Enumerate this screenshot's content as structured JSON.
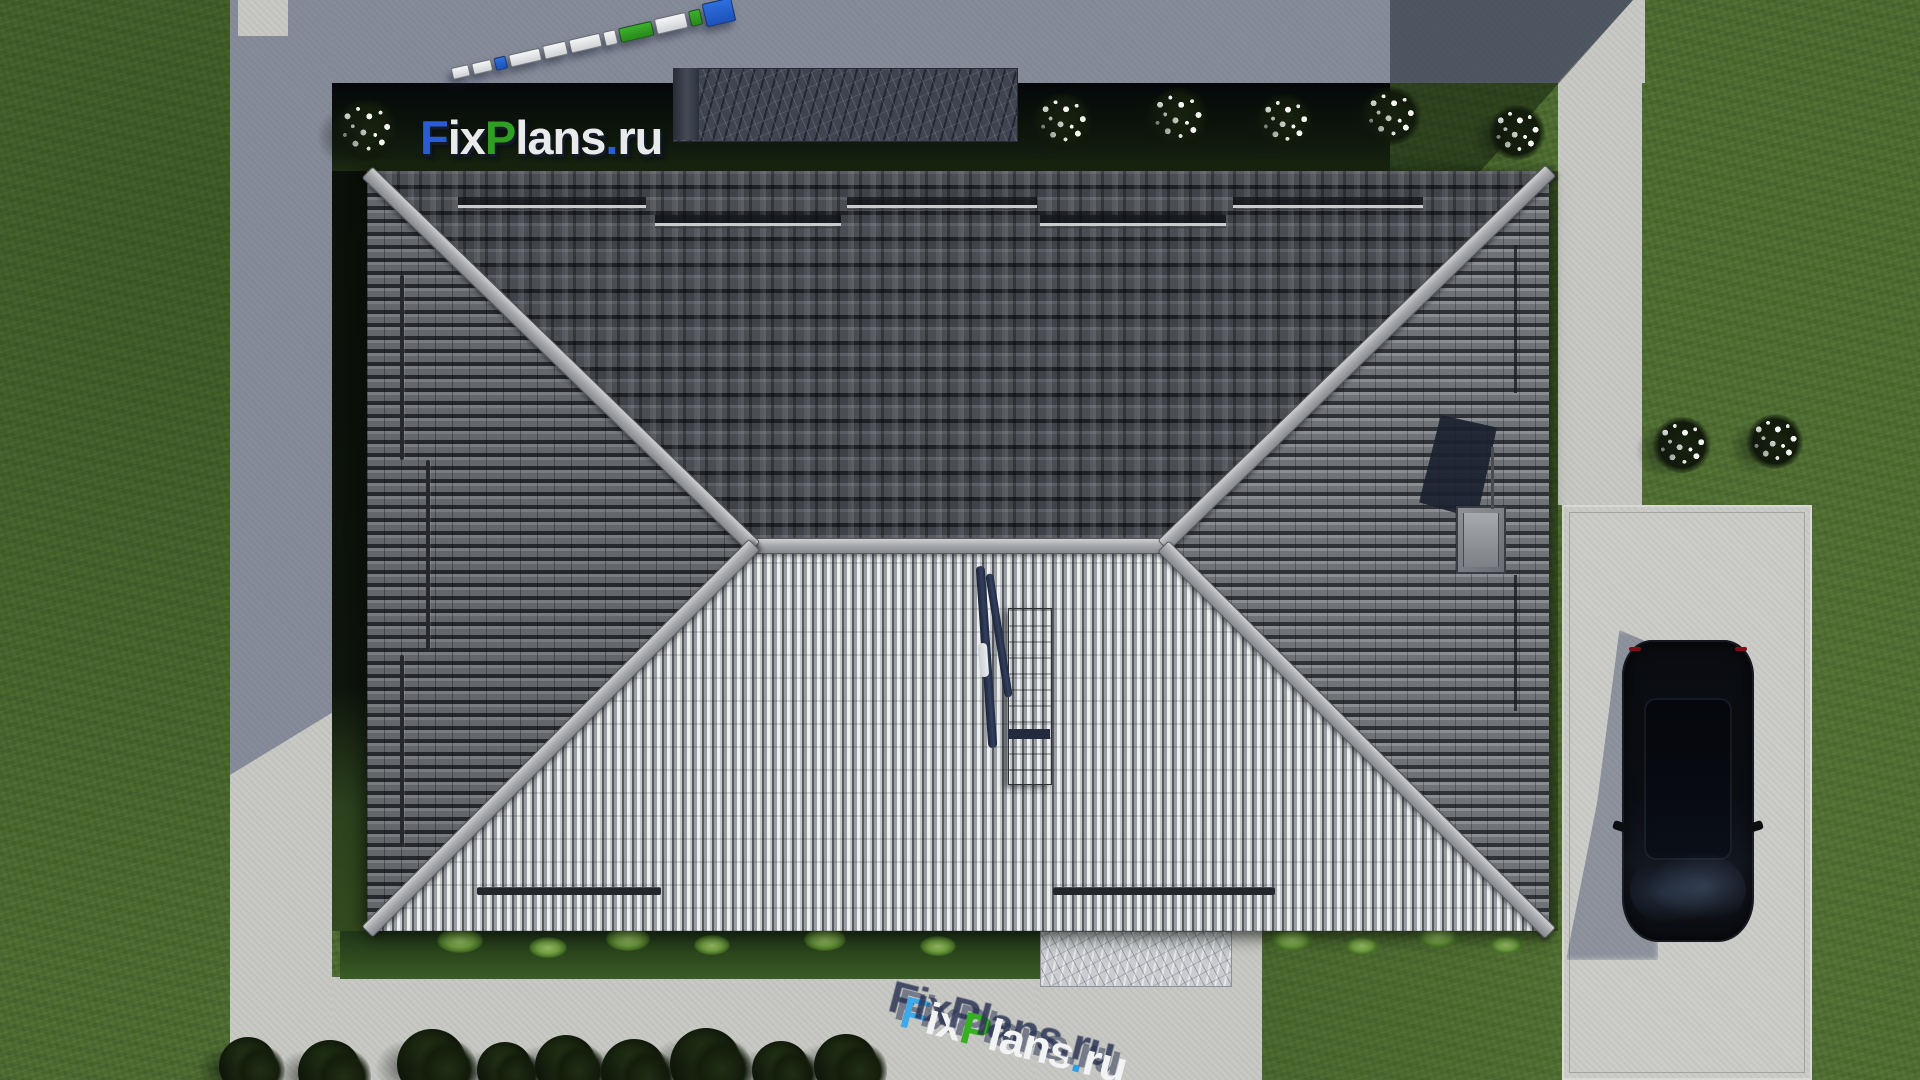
{
  "watermark": {
    "site_top": "FixPlans.ru",
    "site_bottom": "FixPlans.ru",
    "letters_top": [
      {
        "t": "F",
        "c": "#2b5bd7"
      },
      {
        "t": "ix",
        "c": "#e9eaec"
      },
      {
        "t": "P",
        "c": "#2f9e23"
      },
      {
        "t": "lans",
        "c": "#e9eaec"
      },
      {
        "t": ".",
        "c": "#2b5bd7"
      },
      {
        "t": "ru",
        "c": "#e9eaec"
      }
    ],
    "letters_bottom": [
      {
        "t": "F",
        "c": "#3fa8e8"
      },
      {
        "t": "ix",
        "c": "#f2f3f4"
      },
      {
        "t": "P",
        "c": "#35b01e"
      },
      {
        "t": "lans",
        "c": "#f2f3f4"
      },
      {
        "t": ".",
        "c": "#2e9fe6"
      },
      {
        "t": "ru",
        "c": "#f2f3f4"
      }
    ]
  },
  "colors": {
    "brand_blue": "#1d5fd2",
    "brand_green": "#2f9e23",
    "grass": "#4d6c30",
    "pavement": "#c7c8c4",
    "roof_dark_tile": "#3b3d42",
    "roof_light_seam": "#c3c6c9",
    "ridge_cap": "#a7a9ad",
    "shadow_tint": "rgba(44,56,94,0.42)",
    "car_body": "#0b0e13"
  },
  "scene": {
    "ruler_segments": [
      {
        "w": 16,
        "h": 10,
        "c": "w"
      },
      {
        "w": 18,
        "h": 10,
        "c": "w"
      },
      {
        "w": 10,
        "h": 11,
        "c": "b"
      },
      {
        "w": 30,
        "h": 11,
        "c": "w"
      },
      {
        "w": 22,
        "h": 12,
        "c": "w"
      },
      {
        "w": 30,
        "h": 12,
        "c": "w"
      },
      {
        "w": 11,
        "h": 13,
        "c": "w"
      },
      {
        "w": 32,
        "h": 13,
        "c": "g"
      },
      {
        "w": 30,
        "h": 14,
        "c": "w"
      },
      {
        "w": 10,
        "h": 14,
        "c": "g"
      },
      {
        "w": 28,
        "h": 22,
        "c": "b"
      }
    ],
    "flower_bushes": [
      {
        "x": 366,
        "y": 132,
        "s": 66
      },
      {
        "x": 1063,
        "y": 124,
        "s": 62
      },
      {
        "x": 1178,
        "y": 120,
        "s": 64
      },
      {
        "x": 1285,
        "y": 124,
        "s": 60
      },
      {
        "x": 1391,
        "y": 118,
        "s": 62
      },
      {
        "x": 1517,
        "y": 134,
        "s": 58
      },
      {
        "x": 1682,
        "y": 447,
        "s": 60
      },
      {
        "x": 1775,
        "y": 443,
        "s": 58
      }
    ],
    "bed_shrubs": [
      {
        "x": 460,
        "y": 942,
        "s": 46
      },
      {
        "x": 548,
        "y": 948,
        "s": 38
      },
      {
        "x": 628,
        "y": 940,
        "s": 44
      },
      {
        "x": 712,
        "y": 946,
        "s": 36
      },
      {
        "x": 825,
        "y": 941,
        "s": 42
      },
      {
        "x": 938,
        "y": 947,
        "s": 36
      },
      {
        "x": 1292,
        "y": 941,
        "s": 42
      },
      {
        "x": 1362,
        "y": 946,
        "s": 34
      },
      {
        "x": 1438,
        "y": 938,
        "s": 42
      },
      {
        "x": 1506,
        "y": 945,
        "s": 34
      }
    ],
    "bottom_trees": [
      {
        "x": 248,
        "y": 1066,
        "s": 58
      },
      {
        "x": 330,
        "y": 1072,
        "s": 64
      },
      {
        "x": 432,
        "y": 1064,
        "s": 70
      },
      {
        "x": 505,
        "y": 1070,
        "s": 56
      },
      {
        "x": 566,
        "y": 1066,
        "s": 62
      },
      {
        "x": 634,
        "y": 1072,
        "s": 66
      },
      {
        "x": 706,
        "y": 1064,
        "s": 72
      },
      {
        "x": 781,
        "y": 1070,
        "s": 58
      },
      {
        "x": 846,
        "y": 1066,
        "s": 64
      }
    ],
    "snow_bars": [
      {
        "x": 91,
        "y": 26,
        "w": 188
      },
      {
        "x": 288,
        "y": 44,
        "w": 186
      },
      {
        "x": 480,
        "y": 26,
        "w": 190
      },
      {
        "x": 673,
        "y": 44,
        "w": 186
      },
      {
        "x": 866,
        "y": 26,
        "w": 190
      }
    ],
    "eave_bars": [
      {
        "x": 110,
        "y": 716,
        "w": 184
      },
      {
        "x": 686,
        "y": 716,
        "w": 222
      }
    ],
    "ladder_bars": [
      {
        "x": 33,
        "y": 104,
        "h": 185
      },
      {
        "x": 59,
        "y": 289,
        "h": 190
      },
      {
        "x": 33,
        "y": 484,
        "h": 192
      }
    ],
    "right_bars": [
      {
        "x": 1147,
        "y": 74,
        "h": 148
      },
      {
        "x": 1147,
        "y": 404,
        "h": 136
      }
    ]
  }
}
